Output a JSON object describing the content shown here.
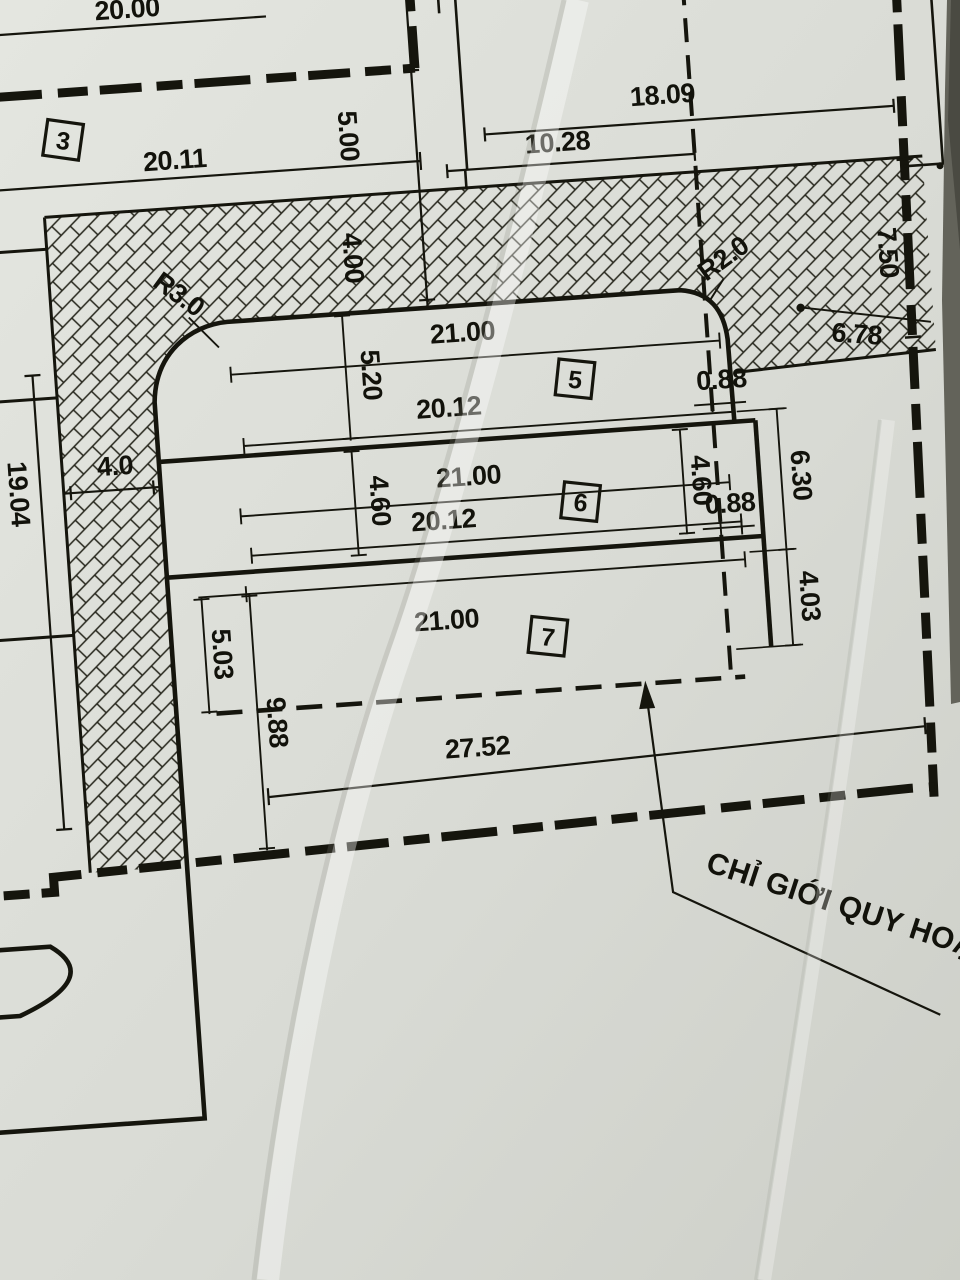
{
  "colors": {
    "paper": "#dcded8",
    "ink": "#15150d"
  },
  "parcels": {
    "p3": "3",
    "p5": "5",
    "p6": "6",
    "p7": "7"
  },
  "dims": {
    "d2000": "20.00",
    "d2011": "20.11",
    "d500": "5.00",
    "d400": "4.00",
    "d1028": "10.28",
    "d1809": "18.09",
    "d750": "7.50",
    "d678": "6.78",
    "r2": "R2.0",
    "r3": "R3.0",
    "d088": "0.88",
    "d630": "6.30",
    "d403": "4.03",
    "d1904": "19.04",
    "d40": "4.0",
    "d2100": "21.00",
    "d2012": "20.12",
    "d520": "5.20",
    "d460": "4.60",
    "d503": "5.03",
    "d988": "9.88",
    "d2752": "27.52"
  },
  "labels": {
    "planning_boundary": "CHỈ GIỚI QUY HOẠCH"
  }
}
